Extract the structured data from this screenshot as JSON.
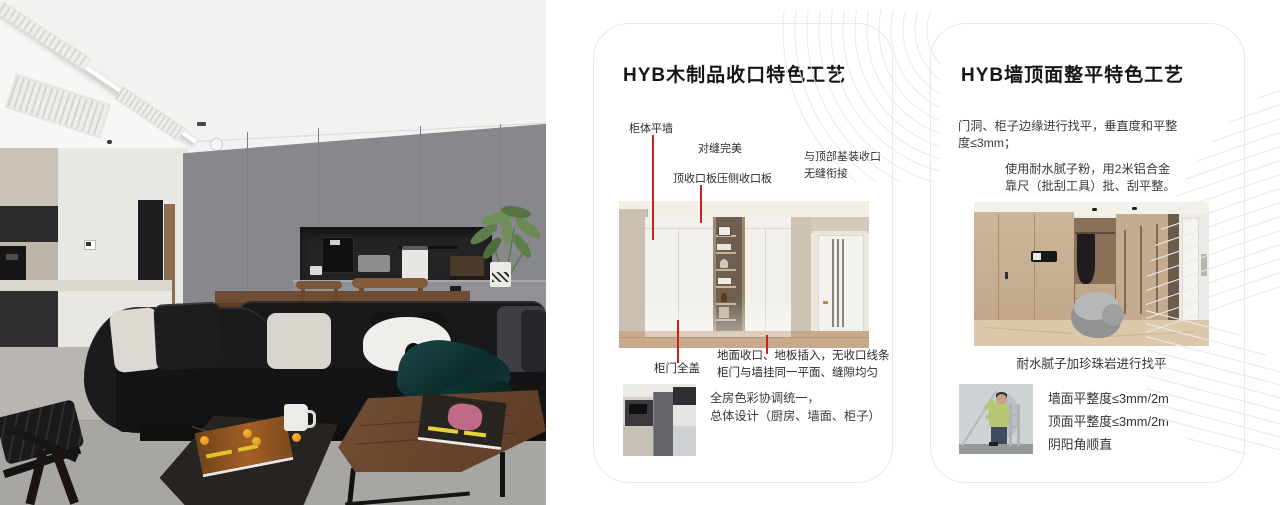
{
  "colors": {
    "accent_red": "#c8231c",
    "card_border": "#e9e9e9",
    "pattern_line": "#e9e9e9"
  },
  "card_wood": {
    "title": "HYB木制品收口特色工艺",
    "callout_cabinet_flush_wall": "柜体平墙",
    "callout_perfect_seam": "对缝完美",
    "callout_top_panel": "顶收口板压侧收口板",
    "callout_top_join_l1": "与顶部基装收口",
    "callout_top_join_l2": "无缝衔接",
    "callout_full_cover_door": "柜门全盖",
    "note_l1": "地面收口、地板插入，无收口线条",
    "note_l2": "柜门与墙挂同一平面、缝隙均匀",
    "summary_l1": "全房色彩协调统一，",
    "summary_l2": "总体设计（厨房、墙面、柜子）"
  },
  "card_wall": {
    "title": "HYB墙顶面整平特色工艺",
    "para1_l1": "门洞、柜子边缘进行找平，垂直度和平整",
    "para1_l2": "度≤3mm；",
    "para2_l1": "使用耐水腻子粉，用2米铝合金",
    "para2_l2": "靠尺（批刮工具）批、刮平整。",
    "caption": "耐水腻子加珍珠岩进行找平",
    "spec_wall": "墙面平整度≤3mm/2m",
    "spec_ceiling": "顶面平整度≤3mm/2m",
    "spec_corner": "阴阳角顺直"
  }
}
